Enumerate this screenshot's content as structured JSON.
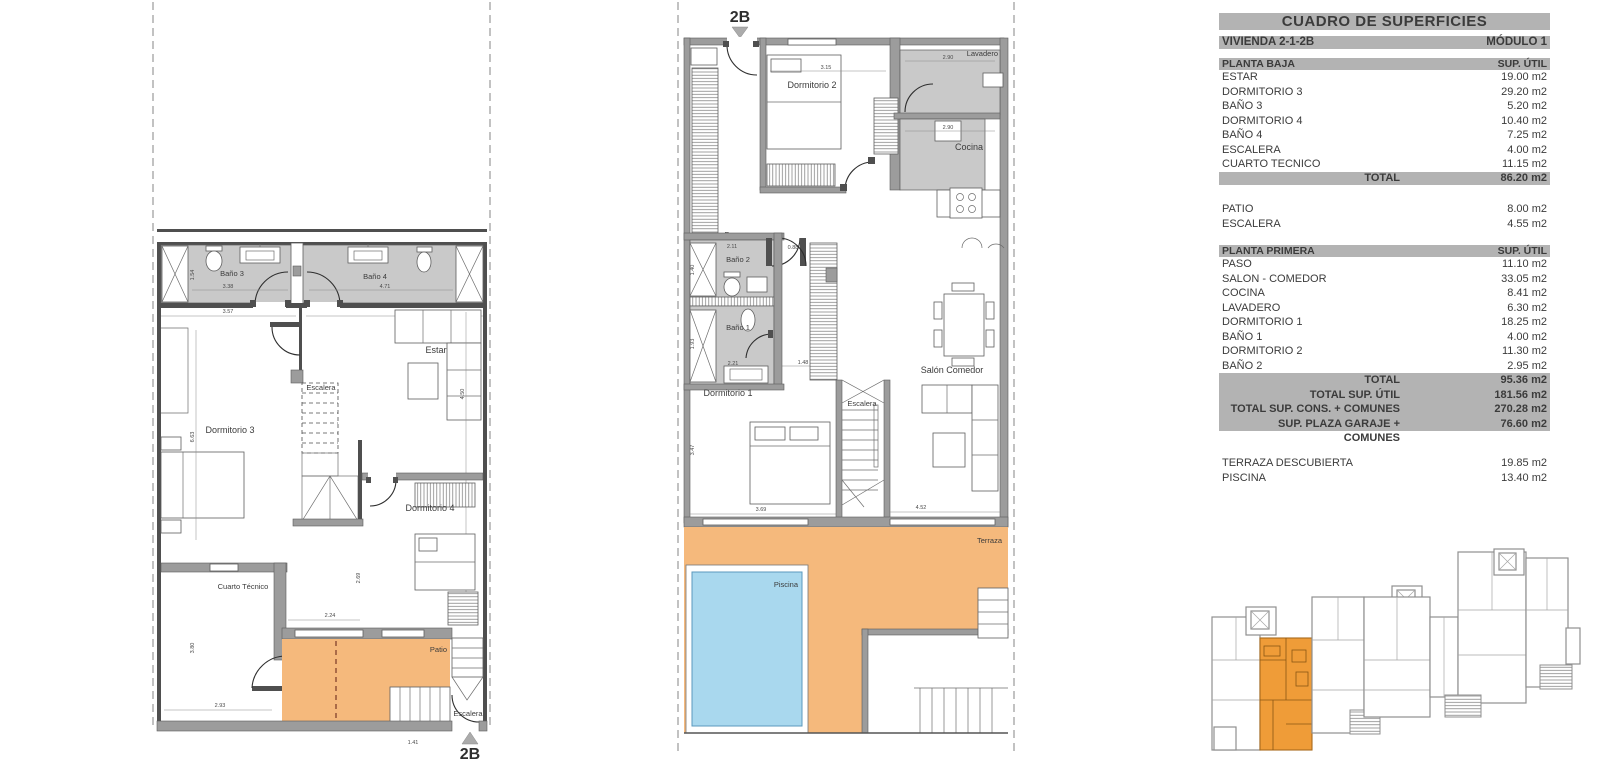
{
  "table": {
    "title": "CUADRO DE SUPERFICIES",
    "unit_bar": {
      "left": "VIVIENDA 2-1-2B",
      "right": "MÓDULO 1"
    },
    "planta_baja": {
      "header": "PLANTA BAJA",
      "header_col": "SUP. ÚTIL",
      "rows": [
        {
          "label": "ESTAR",
          "value": "19.00 m2"
        },
        {
          "label": "DORMITORIO 3",
          "value": "29.20 m2"
        },
        {
          "label": "BAÑO 3",
          "value": "5.20 m2"
        },
        {
          "label": "DORMITORIO 4",
          "value": "10.40 m2"
        },
        {
          "label": "BAÑO 4",
          "value": "7.25 m2"
        },
        {
          "label": "ESCALERA",
          "value": "4.00 m2"
        },
        {
          "label": "CUARTO TECNICO",
          "value": "11.15 m2"
        }
      ],
      "total": {
        "label": "TOTAL",
        "value": "86.20 m2"
      }
    },
    "exterior_baja": [
      {
        "label": "PATIO",
        "value": "8.00 m2"
      },
      {
        "label": "ESCALERA",
        "value": "4.55 m2"
      }
    ],
    "planta_primera": {
      "header": "PLANTA PRIMERA",
      "header_col": "SUP. ÚTIL",
      "rows": [
        {
          "label": "PASO",
          "value": "11.10 m2"
        },
        {
          "label": "SALON - COMEDOR",
          "value": "33.05 m2"
        },
        {
          "label": "COCINA",
          "value": "8.41 m2"
        },
        {
          "label": "LAVADERO",
          "value": "6.30 m2"
        },
        {
          "label": "DORMITORIO 1",
          "value": "18.25 m2"
        },
        {
          "label": "BAÑO 1",
          "value": "4.00 m2"
        },
        {
          "label": "DORMITORIO 2",
          "value": "11.30 m2"
        },
        {
          "label": "BAÑO 2",
          "value": "2.95 m2"
        }
      ],
      "totals": [
        {
          "label": "TOTAL",
          "value": "95.36 m2"
        },
        {
          "label": "TOTAL SUP. ÚTIL",
          "value": "181.56 m2"
        },
        {
          "label": "TOTAL SUP. CONS. + COMUNES",
          "value": "270.28 m2"
        },
        {
          "label": "SUP. PLAZA GARAJE + COMUNES",
          "value": "76.60 m2"
        }
      ]
    },
    "exterior_primera": [
      {
        "label": "TERRAZA DESCUBIERTA",
        "value": "19.85 m2"
      },
      {
        "label": "PISCINA",
        "value": "13.40 m2"
      }
    ]
  },
  "ground_floor": {
    "marker": "2B",
    "rooms": {
      "bano3": "Baño 3",
      "bano4": "Baño 4",
      "estar": "Estar",
      "dormitorio3": "Dormitorio 3",
      "escalera": "Escalera",
      "dormitorio4": "Dormitorio 4",
      "cuarto_tecnico": "Cuarto Técnico",
      "patio": "Patio",
      "escalera_ext": "Escalera"
    },
    "dims": {
      "d338": "3.38",
      "d471": "4.71",
      "d154": "1.54",
      "d357": "3.57",
      "d663": "6.63",
      "d450": "4.50",
      "d380": "3.80",
      "d293": "2.93",
      "d224": "2.24",
      "d269": "2.69",
      "d141": "1.41"
    }
  },
  "first_floor": {
    "marker": "2B",
    "rooms": {
      "paso": "Paso",
      "dormitorio2": "Dormitorio 2",
      "lavadero": "Lavadero",
      "cocina": "Cocina",
      "bano2": "Baño 2",
      "bano1": "Baño 1",
      "dormitorio1": "Dormitorio 1",
      "escalera": "Escalera",
      "salon": "Salón Comedor",
      "terraza": "Terraza",
      "piscina": "Piscina"
    },
    "dims": {
      "d315": "3.15",
      "d290a": "2.90",
      "d290b": "2.90",
      "d211": "2.11",
      "d088": "0.88",
      "d140": "1.40",
      "d193": "1.93",
      "d221": "2.21",
      "d148": "1.48",
      "d347": "3.47",
      "d369": "3.69",
      "d452": "4.52"
    }
  },
  "colors": {
    "terrace_orange": "#f5b97c",
    "pool_blue": "#a9d8ee",
    "highlight_orange": "#ef9c38",
    "wall_gray": "#9c9c9c",
    "room_gray": "#c9c9c9",
    "bar_gray": "#b3b3b3"
  }
}
